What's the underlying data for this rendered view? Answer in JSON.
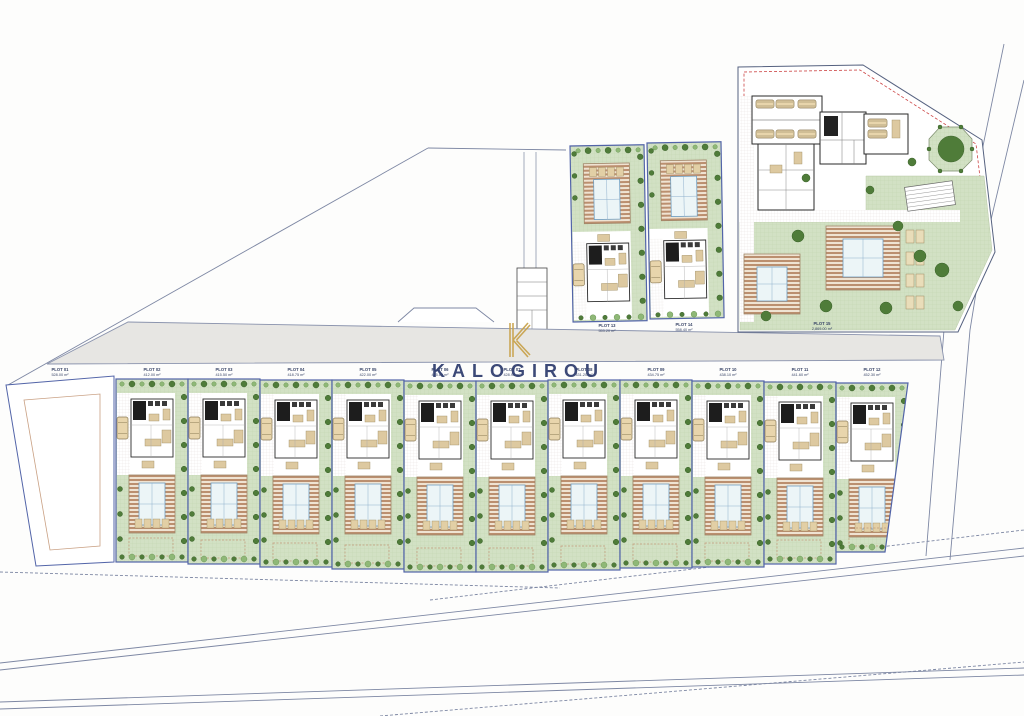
{
  "watermark": {
    "brand": "KALOGIROU",
    "logo_letter": "K"
  },
  "colors": {
    "accent_gold": "#c8a24b",
    "brand_navy": "#2e3c6e",
    "lawn_green": "#d2e1c4",
    "road_gray": "#e7e6e3",
    "plot_border_blue": "#5264a8",
    "deck_brown": "#bb8f6f",
    "pool_blue": "#ecf5f7",
    "tree_green": "#4f7c39",
    "boundary_red": "#cc4444",
    "line_gray": "#7d87a3",
    "label_navy": "#3a4668"
  },
  "plots": {
    "bottom_row": [
      {
        "label": "PLOT 01",
        "area": "528.00 m²",
        "kind": "empty"
      },
      {
        "label": "PLOT 02",
        "area": "412.00 m²",
        "kind": "villa"
      },
      {
        "label": "PLOT 03",
        "area": "415.50 m²",
        "kind": "villa"
      },
      {
        "label": "PLOT 04",
        "area": "418.75 m²",
        "kind": "villa"
      },
      {
        "label": "PLOT 05",
        "area": "422.00 m²",
        "kind": "villa"
      },
      {
        "label": "PLOT 06",
        "area": "425.60 m²",
        "kind": "villa"
      },
      {
        "label": "PLOT 07",
        "area": "428.90 m²",
        "kind": "villa"
      },
      {
        "label": "PLOT 08",
        "area": "431.20 m²",
        "kind": "villa"
      },
      {
        "label": "PLOT 09",
        "area": "434.75 m²",
        "kind": "villa"
      },
      {
        "label": "PLOT 10",
        "area": "438.10 m²",
        "kind": "villa"
      },
      {
        "label": "PLOT 11",
        "area": "441.60 m²",
        "kind": "villa"
      },
      {
        "label": "PLOT 12",
        "area": "452.30 m²",
        "kind": "villa"
      }
    ],
    "upper_row": [
      {
        "label": "PLOT 13",
        "area": "553.20 m²",
        "kind": "villa"
      },
      {
        "label": "PLOT 14",
        "area": "558.40 m²",
        "kind": "villa"
      },
      {
        "label": "PLOT 15",
        "area": "2,869.00 m²",
        "kind": "complex"
      }
    ]
  }
}
